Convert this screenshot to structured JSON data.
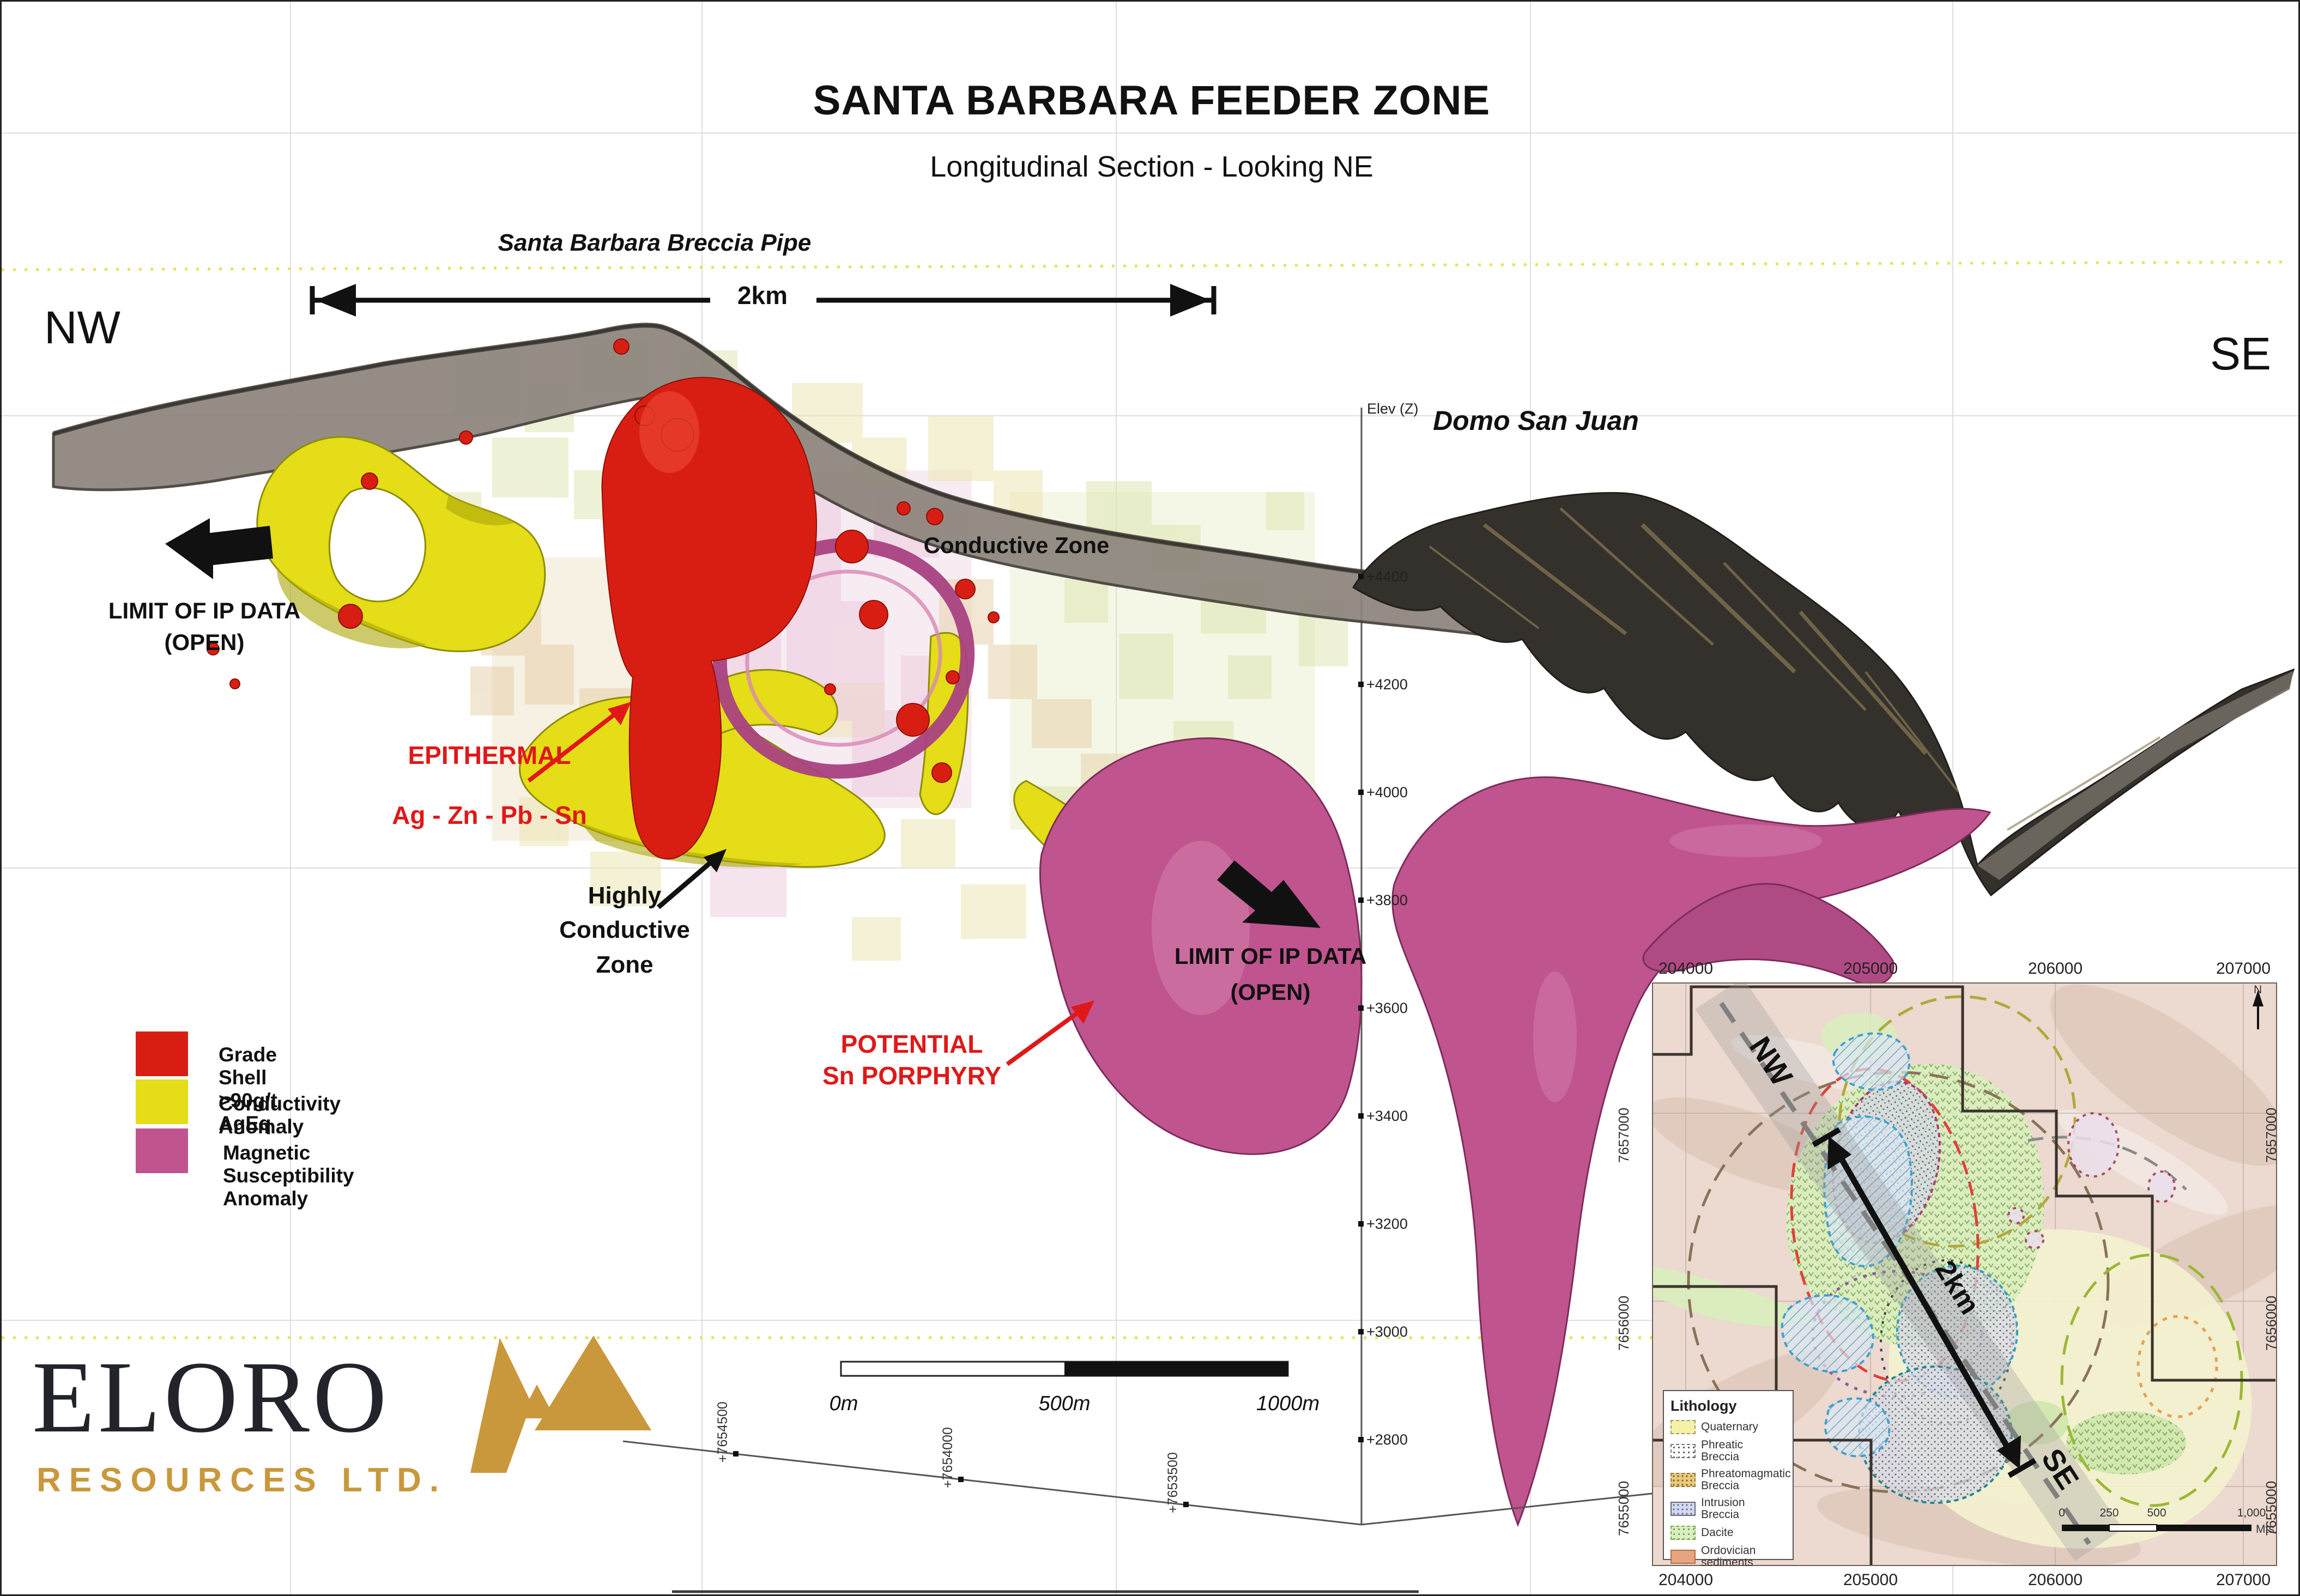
{
  "header": {
    "title": "SANTA BARBARA FEEDER ZONE",
    "subtitle": "Longitudinal Section - Looking NE"
  },
  "section": {
    "nw": "NW",
    "se": "SE",
    "breccia_pipe_label": "Santa Barbara Breccia Pipe",
    "breccia_pipe_span": "2km",
    "labels": {
      "conductive_zone": "Conductive Zone",
      "domo_san_juan": "Domo San Juan",
      "limit_ip_left_1": "LIMIT OF IP DATA",
      "limit_ip_left_2": "(OPEN)",
      "epithermal_1": "EPITHERMAL",
      "epithermal_2": "Ag - Zn - Pb - Sn",
      "highly_conductive_1": "Highly",
      "highly_conductive_2": "Conductive",
      "highly_conductive_3": "Zone",
      "potential_1": "POTENTIAL",
      "potential_2": "Sn PORPHYRY",
      "limit_ip_right_1": "LIMIT OF IP DATA",
      "limit_ip_right_2": "(OPEN)"
    },
    "elevation_axis": {
      "title": "Elev (Z)",
      "ticks": [
        "+4400",
        "+4200",
        "+4000",
        "+3800",
        "+3600",
        "+3400",
        "+3200",
        "+3000",
        "+2800"
      ]
    },
    "northing_axis": {
      "ticks": [
        "+7654500",
        "+7654000",
        "+7653500"
      ]
    },
    "scale_bar": {
      "start": "0m",
      "mid": "500m",
      "end": "1000m"
    }
  },
  "legend": {
    "items": [
      {
        "label": "Grade Shell >90g/t AgEq",
        "color": "#d81e12"
      },
      {
        "label": "Conductivity Anomaly",
        "color": "#e4dd17"
      },
      {
        "label": "Magnetic Susceptibility Anomaly",
        "color": "#c0548e"
      }
    ]
  },
  "inset_map": {
    "eastings": [
      "204000",
      "205000",
      "206000",
      "207000"
    ],
    "northings": [
      "7657000",
      "7656000",
      "7655000"
    ],
    "nw": "NW",
    "se": "SE",
    "distance": "2km",
    "north": "N",
    "scale": {
      "t0": "0",
      "t1": "250",
      "t2": "500",
      "t3": "1,000",
      "unit": "Mts."
    },
    "lithology": {
      "title": "Lithology",
      "items": [
        {
          "line1": "Quaternary",
          "line2": ""
        },
        {
          "line1": "Phreatic",
          "line2": "Breccia"
        },
        {
          "line1": "Phreatomagmatic",
          "line2": "Breccia"
        },
        {
          "line1": "Intrusion",
          "line2": "Breccia"
        },
        {
          "line1": "Dacite",
          "line2": ""
        },
        {
          "line1": "Ordovician",
          "line2": "sediments"
        }
      ]
    }
  },
  "logo": {
    "name": "ELORO",
    "subtitle": "RESOURCES LTD."
  },
  "colors": {
    "grade_shell": "#d81e12",
    "conductivity": "#e4dd17",
    "magnetic": "#c0548e",
    "logo_gold": "#c9983c",
    "annotation_red": "#e01818"
  }
}
